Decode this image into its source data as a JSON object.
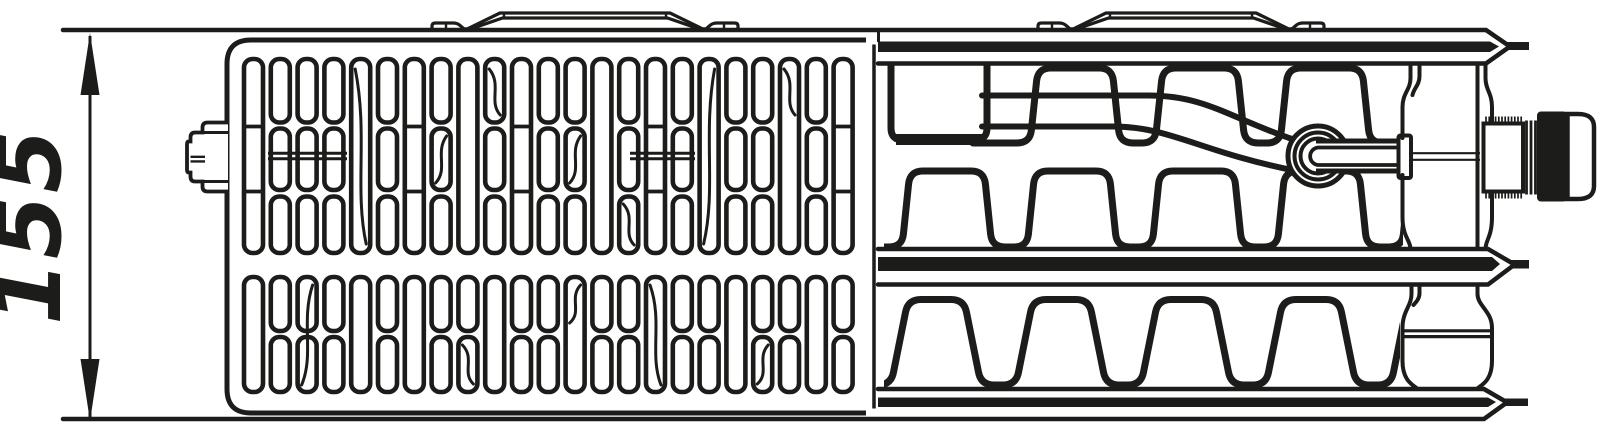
{
  "dimension": {
    "label": "155"
  },
  "colors": {
    "ink": "#1c1c1a",
    "paper": "#ffffff"
  },
  "drawing": {
    "grille": {
      "column_start": 244,
      "column_pitch": 26.8,
      "slot_width": 19,
      "upper_band": {
        "y1": 59,
        "y2": 253,
        "segs": [
          [
            59,
            122.5
          ],
          [
            128.5,
            190
          ],
          [
            196.5,
            253
          ]
        ],
        "dividers": [
          126.5,
          191.5
        ]
      },
      "lower_band": {
        "y1": 277,
        "y2": 392,
        "segs": [
          [
            277,
            331
          ],
          [
            337,
            392
          ]
        ],
        "dividers": [
          333
        ]
      },
      "upper_pattern": [
        "tD",
        "s3L",
        "s3L",
        "s3L",
        "t",
        "s3",
        "tD",
        "s3c",
        "t",
        "s3",
        "tD",
        "s3",
        "s3c",
        "t",
        "s3",
        "tD",
        "s3",
        "t",
        "s3c",
        "s3L",
        "t",
        "s3",
        "tD"
      ],
      "lower_pattern": [
        "t",
        "s2",
        "s2",
        "s2",
        "t",
        "s2",
        "t",
        "s2",
        "s2",
        "t",
        "s2",
        "s2",
        "t",
        "s2",
        "s2",
        "t",
        "s2",
        "s2",
        "t",
        "s2",
        "s2",
        "t",
        "s2"
      ],
      "mid_rails": [
        {
          "x1": 268,
          "x2": 347
        },
        {
          "x1": 630,
          "x2": 695
        }
      ],
      "rail_y": [
        153.2,
        158.8
      ],
      "accents": [
        {
          "col": 4,
          "band": "u",
          "y1": 64,
          "y2": 248
        },
        {
          "col": 7,
          "band": "u",
          "y1": 131,
          "y2": 187
        },
        {
          "col": 9,
          "band": "u",
          "y1": 64,
          "y2": 119
        },
        {
          "col": 12,
          "band": "u",
          "y1": 131,
          "y2": 187
        },
        {
          "col": 14,
          "band": "u",
          "y1": 199,
          "y2": 249
        },
        {
          "col": 17,
          "band": "u",
          "y1": 64,
          "y2": 248
        },
        {
          "col": 20,
          "band": "u",
          "y1": 64,
          "y2": 119
        },
        {
          "col": 2,
          "band": "l",
          "y1": 280,
          "y2": 389
        },
        {
          "col": 8,
          "band": "l",
          "y1": 340,
          "y2": 388
        },
        {
          "col": 12,
          "band": "l",
          "y1": 280,
          "y2": 327
        },
        {
          "col": 15,
          "band": "l",
          "y1": 280,
          "y2": 389
        },
        {
          "col": 19,
          "band": "l",
          "y1": 340,
          "y2": 388
        }
      ]
    },
    "fins": {
      "upper_a": {
        "x0": 995,
        "top": 68,
        "bottom": 143,
        "x_end": 1405,
        "valley_w": 35,
        "top_w": 74,
        "slant": 8
      },
      "upper_b": {
        "x0": 867,
        "top": 171,
        "bottom": 247,
        "x_end": 1405,
        "valley_w": 35,
        "top_w": 74,
        "slant": 8
      },
      "lower": {
        "x0": 856,
        "top": 299.5,
        "bottom": 385,
        "x_end": 1402,
        "valley_w": 35,
        "top_w": 56,
        "slant": 17
      }
    },
    "knurl": {
      "x1": 1486,
      "x2": 1521.5,
      "step": 3.2,
      "top": [
        116.5,
        124
      ],
      "bottom": [
        191,
        198.5
      ]
    }
  }
}
